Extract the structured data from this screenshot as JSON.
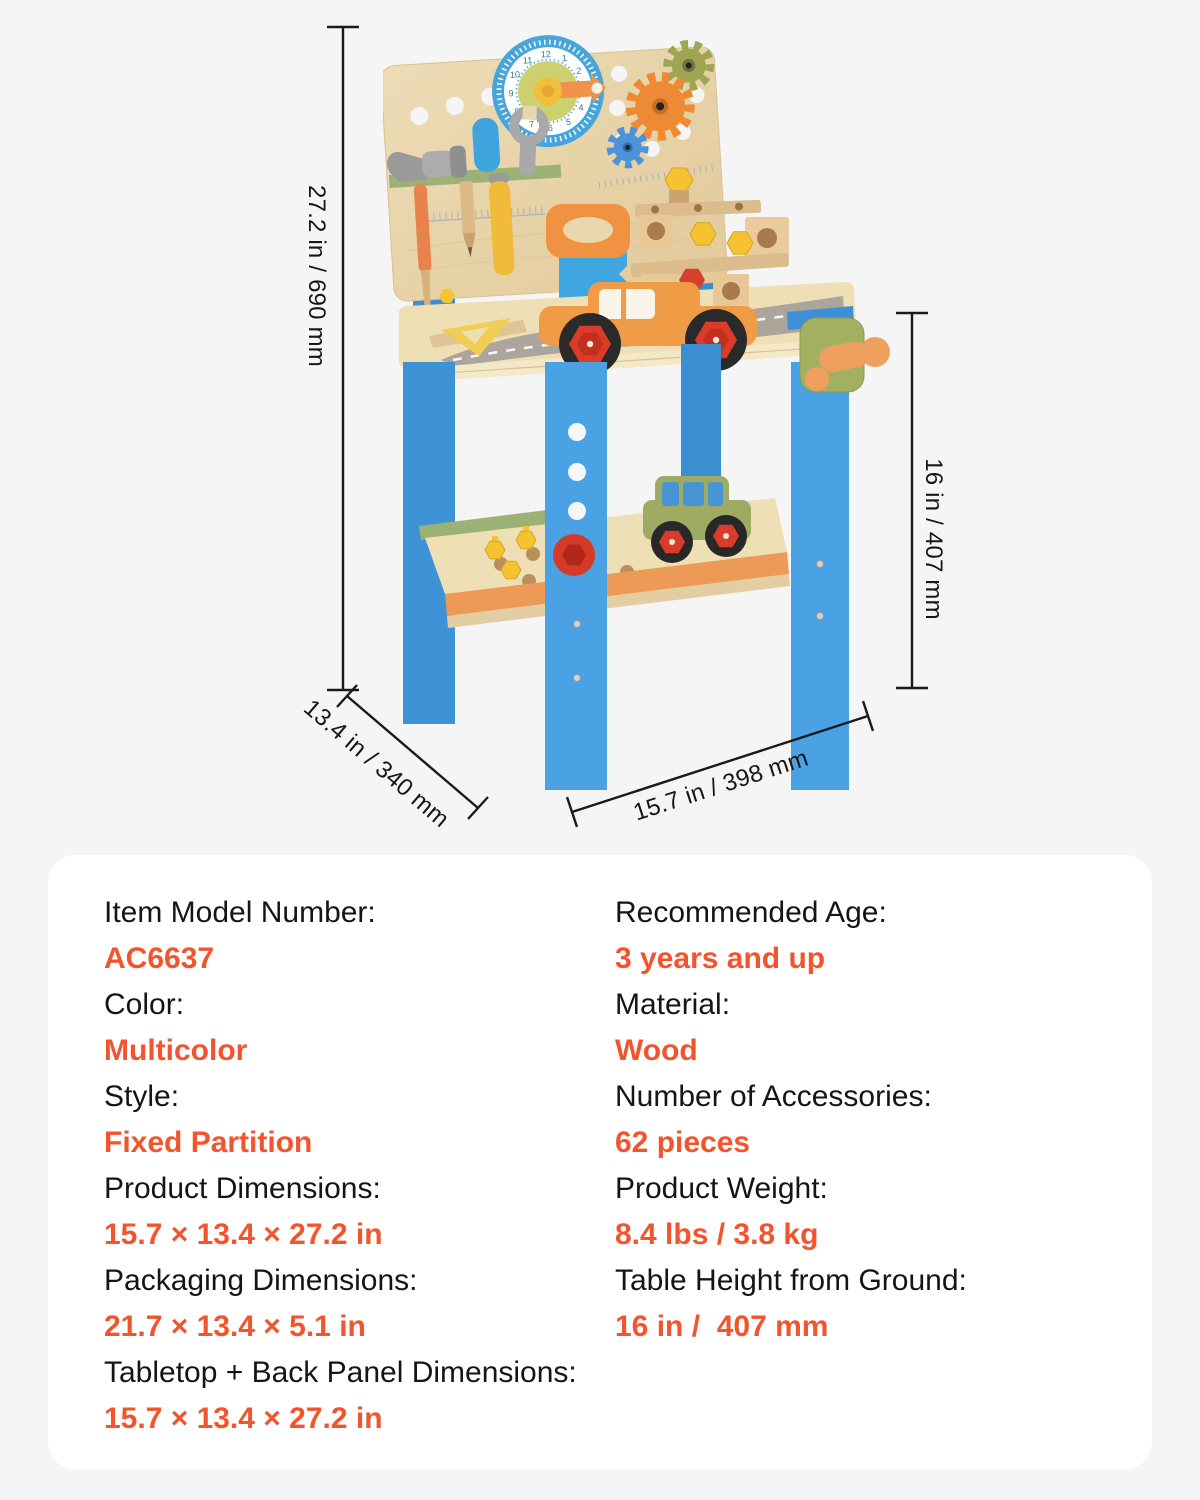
{
  "colors": {
    "page_bg": "#F5F5F6",
    "card_bg": "#FFFFFF",
    "accent_orange": "#F2542D",
    "text_dark": "#151515",
    "dimension_line": "#1A1A1A"
  },
  "product_image": {
    "clock_numbers": [
      "12",
      "1",
      "2",
      "3",
      "4",
      "5",
      "6",
      "7",
      "8",
      "9",
      "10",
      "11"
    ],
    "palette": {
      "wood": "#EADAB3",
      "blue": "#46A0E0",
      "green": "#9CB175",
      "orange": "#EE9A4C",
      "yellow": "#F5C331",
      "red": "#D6402C",
      "gray": "#A8A8A8"
    }
  },
  "dimensions": {
    "height": "27.2 in / 690 mm",
    "depth": "13.4 in / 340 mm",
    "width": "15.7 in / 398 mm",
    "table_height": "16 in / 407 mm"
  },
  "specs": {
    "left": [
      {
        "label": "Item Model Number:",
        "value": "AC6637"
      },
      {
        "label": "Color:",
        "value": "Multicolor"
      },
      {
        "label": "Style:",
        "value": "Fixed Partition"
      },
      {
        "label": "Product Dimensions:",
        "value": "15.7 × 13.4 × 27.2 in"
      },
      {
        "label": "Packaging Dimensions:",
        "value": "21.7 × 13.4 × 5.1 in"
      },
      {
        "label": "Tabletop + Back Panel Dimensions:",
        "value": "15.7 × 13.4 × 27.2 in"
      }
    ],
    "right": [
      {
        "label": "Recommended Age:",
        "value": "3 years and up"
      },
      {
        "label": "Material:",
        "value": "Wood"
      },
      {
        "label": "Number of Accessories:",
        "value": "62 pieces"
      },
      {
        "label": "Product Weight:",
        "value": "8.4 lbs / 3.8 kg"
      },
      {
        "label": "Table Height from Ground:",
        "value": "16 in /  407 mm"
      }
    ]
  }
}
